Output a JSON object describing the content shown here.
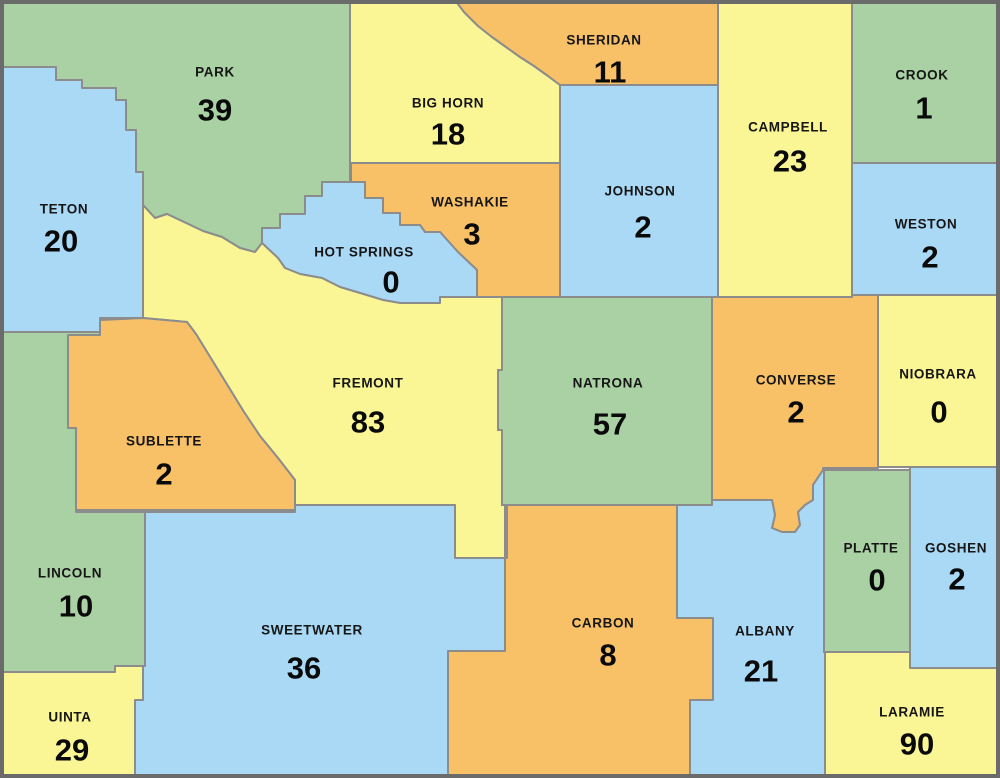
{
  "map": {
    "region": "Wyoming counties",
    "palette": {
      "green": "#a9d1a3",
      "blue": "#aad9f6",
      "yellow": "#faf595",
      "orange": "#f8c168"
    },
    "border_color": "#8c8c8c",
    "outer_border_color": "#6b6b6b",
    "label_color": "#111111",
    "counties": [
      {
        "id": "park",
        "name": "PARK",
        "value": "39",
        "color": "green",
        "shape": "0,0 350,0 350,182 322,182 322,196 305,196 305,214 280,214 280,228 262,228 262,243 255,252 240,248 222,237 203,231 184,222 167,214 155,218 143,205 143,172 136,172 136,130 126,130 126,100 116,100 116,88 82,88 82,80 56,80 56,67 0,67",
        "name_pos": {
          "x": 215,
          "y": 72
        },
        "value_pos": {
          "x": 215,
          "y": 110
        }
      },
      {
        "id": "bighorn",
        "name": "BIG HORN",
        "value": "18",
        "color": "yellow",
        "shape": "350,0 455,0 464,12 478,26 492,37 506,47 520,57 534,66 548,76 560,85 560,163 350,163",
        "name_pos": {
          "x": 448,
          "y": 103
        },
        "value_pos": {
          "x": 448,
          "y": 134
        }
      },
      {
        "id": "sheridan",
        "name": "SHERIDAN",
        "value": "11",
        "color": "orange",
        "shape": "455,0 718,0 718,85 560,85 548,76 534,66 520,57 506,47 492,37 478,26 464,12",
        "name_pos": {
          "x": 604,
          "y": 40
        },
        "value_pos": {
          "x": 610,
          "y": 72
        }
      },
      {
        "id": "campbell",
        "name": "CAMPBELL",
        "value": "23",
        "color": "yellow",
        "shape": "718,0 852,0 852,297 718,297",
        "name_pos": {
          "x": 788,
          "y": 127
        },
        "value_pos": {
          "x": 790,
          "y": 161
        }
      },
      {
        "id": "crook",
        "name": "CROOK",
        "value": "1",
        "color": "green",
        "shape": "852,0 1000,0 1000,163 852,163",
        "name_pos": {
          "x": 922,
          "y": 75
        },
        "value_pos": {
          "x": 924,
          "y": 108
        }
      },
      {
        "id": "teton",
        "name": "TETON",
        "value": "20",
        "color": "blue",
        "shape": "0,67 56,67 56,80 82,80 82,88 116,88 116,100 126,100 126,130 136,130 136,172 143,172 143,318 100,318 100,332 0,332",
        "name_pos": {
          "x": 64,
          "y": 209
        },
        "value_pos": {
          "x": 61,
          "y": 241
        }
      },
      {
        "id": "johnson",
        "name": "JOHNSON",
        "value": "2",
        "color": "blue",
        "shape": "560,85 718,85 718,297 560,297",
        "name_pos": {
          "x": 640,
          "y": 191
        },
        "value_pos": {
          "x": 643,
          "y": 227
        }
      },
      {
        "id": "weston",
        "name": "WESTON",
        "value": "2",
        "color": "blue",
        "shape": "852,163 1000,163 1000,295 852,295",
        "name_pos": {
          "x": 926,
          "y": 224
        },
        "value_pos": {
          "x": 930,
          "y": 257
        }
      },
      {
        "id": "washakie",
        "name": "WASHAKIE",
        "value": "3",
        "color": "orange",
        "shape": "351,163 560,163 560,297 477,297 477,270 458,252 440,232 425,232 420,225 400,225 400,213 383,213 383,198 365,198 365,182 351,182",
        "name_pos": {
          "x": 470,
          "y": 202
        },
        "value_pos": {
          "x": 472,
          "y": 234
        }
      },
      {
        "id": "hotsprings",
        "name": "HOT SPRINGS",
        "value": "0",
        "color": "blue",
        "shape": "322,182 365,182 365,198 383,198 383,213 400,213 400,225 420,225 425,232 440,232 458,252 477,270 477,297 440,297 440,303 400,303 383,300 360,293 340,287 322,278 300,274 285,268 278,258 262,243 262,228 280,228 280,214 305,214 305,196 322,196",
        "name_pos": {
          "x": 364,
          "y": 252
        },
        "value_pos": {
          "x": 391,
          "y": 282
        }
      },
      {
        "id": "fremont",
        "name": "FREMONT",
        "value": "83",
        "color": "yellow",
        "shape": "143,205 155,218 167,214 184,222 203,231 222,237 240,248 255,252 262,243 278,258 285,268 300,274 322,278 340,287 360,293 383,300 400,303 440,303 440,297 477,297 502,297 502,370 498,370 498,430 502,430 502,505 505,505 505,558 455,558 455,505 295,505 295,480 278,458 260,436 244,412 228,386 212,360 196,334 187,322 143,318",
        "name_pos": {
          "x": 368,
          "y": 383
        },
        "value_pos": {
          "x": 368,
          "y": 422
        }
      },
      {
        "id": "natrona",
        "name": "NATRONA",
        "value": "57",
        "color": "green",
        "shape": "502,297 712,297 712,505 502,505 502,430 498,430 498,370 502,370",
        "name_pos": {
          "x": 608,
          "y": 383
        },
        "value_pos": {
          "x": 610,
          "y": 424
        }
      },
      {
        "id": "converse",
        "name": "CONVERSE",
        "value": "2",
        "color": "orange",
        "shape": "712,297 852,297 852,295 878,295 878,468 823,468 823,470 813,485 813,500 805,505 798,512 800,525 795,532 782,532 772,528 775,515 772,500 712,500",
        "name_pos": {
          "x": 796,
          "y": 380
        },
        "value_pos": {
          "x": 796,
          "y": 412
        }
      },
      {
        "id": "niobrara",
        "name": "NIOBRARA",
        "value": "0",
        "color": "yellow",
        "shape": "878,295 1000,295 1000,467 878,467",
        "name_pos": {
          "x": 938,
          "y": 374
        },
        "value_pos": {
          "x": 939,
          "y": 412
        }
      },
      {
        "id": "sublette",
        "name": "SUBLETTE",
        "value": "2",
        "color": "orange",
        "shape": "68,335 100,335 100,320 143,318 187,322 196,334 212,360 228,386 244,412 260,436 278,458 295,480 295,510 76,510 76,430 68,428",
        "name_pos": {
          "x": 164,
          "y": 441
        },
        "value_pos": {
          "x": 164,
          "y": 474
        }
      },
      {
        "id": "lincoln",
        "name": "LINCOLN",
        "value": "10",
        "color": "green",
        "shape": "0,332 100,332 100,335 68,335 68,428 76,428 76,512 145,512 145,666 115,666 115,672 0,672",
        "name_pos": {
          "x": 70,
          "y": 573
        },
        "value_pos": {
          "x": 76,
          "y": 606
        }
      },
      {
        "id": "sweetwater",
        "name": "SWEETWATER",
        "value": "36",
        "color": "blue",
        "shape": "145,512 295,512 295,505 455,505 455,558 505,558 505,651 448,651 448,778 135,778 135,700 143,700 143,666 145,666",
        "name_pos": {
          "x": 312,
          "y": 630
        },
        "value_pos": {
          "x": 304,
          "y": 668
        }
      },
      {
        "id": "uinta",
        "name": "UINTA",
        "value": "29",
        "color": "yellow",
        "shape": "0,672 115,672 115,666 143,666 143,700 135,700 135,778 0,778",
        "name_pos": {
          "x": 70,
          "y": 717
        },
        "value_pos": {
          "x": 72,
          "y": 750
        }
      },
      {
        "id": "carbon",
        "name": "CARBON",
        "value": "8",
        "color": "orange",
        "shape": "507,505 677,505 677,618 713,618 713,700 690,700 690,778 448,778 448,651 505,651 505,558 507,558",
        "name_pos": {
          "x": 603,
          "y": 623
        },
        "value_pos": {
          "x": 608,
          "y": 655
        }
      },
      {
        "id": "albany",
        "name": "ALBANY",
        "value": "21",
        "color": "blue",
        "shape": "677,505 712,505 712,500 772,500 775,515 772,528 782,532 795,532 800,525 798,512 805,505 813,500 813,485 823,470 824,470 824,652 825,652 825,778 690,778 690,700 713,700 713,618 677,618",
        "name_pos": {
          "x": 765,
          "y": 631
        },
        "value_pos": {
          "x": 761,
          "y": 671
        }
      },
      {
        "id": "platte",
        "name": "PLATTE",
        "value": "0",
        "color": "green",
        "shape": "824,470 910,470 910,652 824,652",
        "name_pos": {
          "x": 871,
          "y": 548
        },
        "value_pos": {
          "x": 877,
          "y": 580
        }
      },
      {
        "id": "goshen",
        "name": "GOSHEN",
        "value": "2",
        "color": "blue",
        "shape": "910,467 1000,467 1000,668 910,668",
        "name_pos": {
          "x": 956,
          "y": 548
        },
        "value_pos": {
          "x": 957,
          "y": 579
        }
      },
      {
        "id": "laramie",
        "name": "LARAMIE",
        "value": "90",
        "color": "yellow",
        "shape": "825,652 910,652 910,668 1000,668 1000,778 825,778",
        "name_pos": {
          "x": 912,
          "y": 712
        },
        "value_pos": {
          "x": 917,
          "y": 744
        }
      }
    ]
  }
}
